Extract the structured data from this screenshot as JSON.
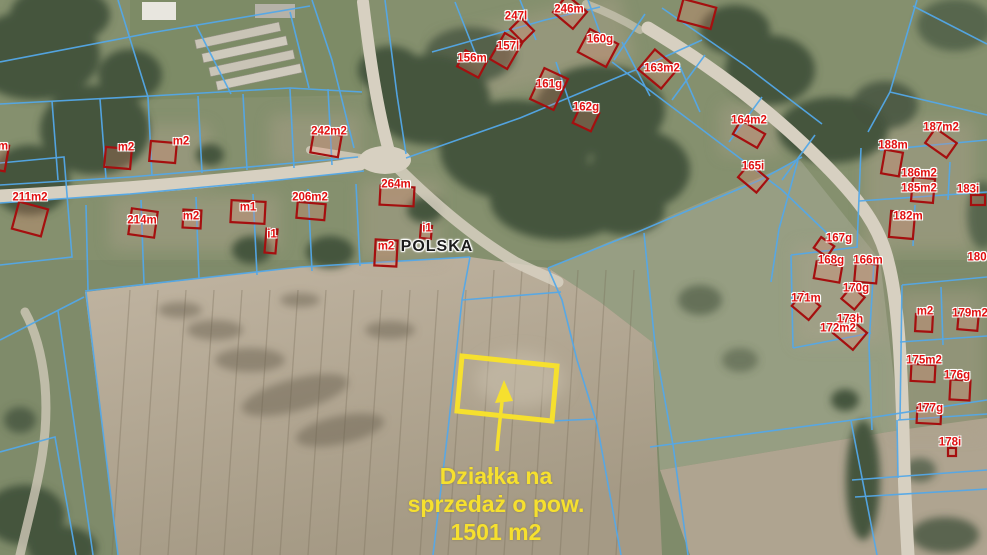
{
  "map": {
    "country_label": "POLSKA",
    "annotation": {
      "line1": "Działka na",
      "line2": "sprzedaż o pow.",
      "line3": "1501 m2",
      "area_value": "1501 m2"
    },
    "colors": {
      "parcel_boundary": "#54a8e8",
      "building_outline": "#a50f0f",
      "building_fill": "rgba(255,130,110,0.22)",
      "label_text": "#e01010",
      "highlight": "#f6e02e",
      "country_text": "#1c1c1c"
    },
    "parcel_labels": [
      {
        "text": "247l",
        "x": 516,
        "y": 17
      },
      {
        "text": "246m",
        "x": 569,
        "y": 10
      },
      {
        "text": "156m",
        "x": 472,
        "y": 59
      },
      {
        "text": "157l",
        "x": 508,
        "y": 47
      },
      {
        "text": "160g",
        "x": 600,
        "y": 40
      },
      {
        "text": "163m2",
        "x": 662,
        "y": 69
      },
      {
        "text": "161g",
        "x": 549,
        "y": 85
      },
      {
        "text": "162g",
        "x": 586,
        "y": 108
      },
      {
        "text": "164m2",
        "x": 749,
        "y": 121
      },
      {
        "text": "165i",
        "x": 753,
        "y": 167
      },
      {
        "text": "187m2",
        "x": 941,
        "y": 128
      },
      {
        "text": "188m",
        "x": 893,
        "y": 146
      },
      {
        "text": "186m2",
        "x": 919,
        "y": 174
      },
      {
        "text": "185m2",
        "x": 919,
        "y": 189
      },
      {
        "text": "183i",
        "x": 968,
        "y": 190
      },
      {
        "text": "182m",
        "x": 908,
        "y": 217
      },
      {
        "text": "167g",
        "x": 839,
        "y": 239
      },
      {
        "text": "168g",
        "x": 831,
        "y": 261
      },
      {
        "text": "166m",
        "x": 868,
        "y": 261
      },
      {
        "text": "170g",
        "x": 856,
        "y": 289
      },
      {
        "text": "171m",
        "x": 806,
        "y": 299
      },
      {
        "text": "173h",
        "x": 850,
        "y": 320
      },
      {
        "text": "172m2",
        "x": 838,
        "y": 329
      },
      {
        "text": "m2",
        "x": 925,
        "y": 312
      },
      {
        "text": "179m2",
        "x": 970,
        "y": 314
      },
      {
        "text": "180",
        "x": 977,
        "y": 258
      },
      {
        "text": "175m2",
        "x": 924,
        "y": 361
      },
      {
        "text": "176g",
        "x": 957,
        "y": 376
      },
      {
        "text": "177g",
        "x": 930,
        "y": 409
      },
      {
        "text": "178i",
        "x": 950,
        "y": 443
      },
      {
        "text": "211m2",
        "x": 30,
        "y": 198
      },
      {
        "text": "m2",
        "x": 126,
        "y": 148
      },
      {
        "text": "m2",
        "x": 181,
        "y": 142
      },
      {
        "text": "242m2",
        "x": 329,
        "y": 132
      },
      {
        "text": "214m",
        "x": 142,
        "y": 221
      },
      {
        "text": "m2",
        "x": 191,
        "y": 217
      },
      {
        "text": "m1",
        "x": 248,
        "y": 208
      },
      {
        "text": "i1",
        "x": 272,
        "y": 235
      },
      {
        "text": "206m2",
        "x": 310,
        "y": 198
      },
      {
        "text": "264m",
        "x": 396,
        "y": 185
      },
      {
        "text": "m2",
        "x": 386,
        "y": 247
      },
      {
        "text": "i1",
        "x": 427,
        "y": 229
      },
      {
        "text": "m",
        "x": 3,
        "y": 147
      }
    ],
    "buildings": [
      {
        "x": 522,
        "y": 30,
        "w": 18,
        "h": 16,
        "r": 45
      },
      {
        "x": 570,
        "y": 12,
        "w": 26,
        "h": 22,
        "r": 40
      },
      {
        "x": 472,
        "y": 64,
        "w": 24,
        "h": 18,
        "r": 28
      },
      {
        "x": 506,
        "y": 51,
        "w": 20,
        "h": 30,
        "r": 30
      },
      {
        "x": 598,
        "y": 48,
        "w": 32,
        "h": 26,
        "r": 28
      },
      {
        "x": 658,
        "y": 69,
        "w": 30,
        "h": 26,
        "r": 40
      },
      {
        "x": 549,
        "y": 89,
        "w": 26,
        "h": 34,
        "r": 25
      },
      {
        "x": 586,
        "y": 118,
        "w": 20,
        "h": 20,
        "r": 25
      },
      {
        "x": 697,
        "y": 14,
        "w": 34,
        "h": 22,
        "r": 15
      },
      {
        "x": 749,
        "y": 134,
        "w": 28,
        "h": 16,
        "r": 30
      },
      {
        "x": 753,
        "y": 178,
        "w": 24,
        "h": 18,
        "r": 40
      },
      {
        "x": 941,
        "y": 143,
        "w": 26,
        "h": 18,
        "r": 35
      },
      {
        "x": 892,
        "y": 163,
        "w": 18,
        "h": 24,
        "r": 10
      },
      {
        "x": 923,
        "y": 190,
        "w": 22,
        "h": 24,
        "r": 5
      },
      {
        "x": 978,
        "y": 200,
        "w": 14,
        "h": 10,
        "r": 0
      },
      {
        "x": 902,
        "y": 225,
        "w": 24,
        "h": 26,
        "r": 5
      },
      {
        "x": 824,
        "y": 247,
        "w": 16,
        "h": 13,
        "r": 35
      },
      {
        "x": 828,
        "y": 272,
        "w": 26,
        "h": 17,
        "r": 10
      },
      {
        "x": 866,
        "y": 273,
        "w": 22,
        "h": 19,
        "r": 5
      },
      {
        "x": 853,
        "y": 298,
        "w": 17,
        "h": 16,
        "r": 40
      },
      {
        "x": 806,
        "y": 306,
        "w": 22,
        "h": 18,
        "r": 40
      },
      {
        "x": 850,
        "y": 333,
        "w": 26,
        "h": 22,
        "r": 40
      },
      {
        "x": 924,
        "y": 323,
        "w": 17,
        "h": 17,
        "r": 3
      },
      {
        "x": 968,
        "y": 322,
        "w": 20,
        "h": 16,
        "r": 5
      },
      {
        "x": 923,
        "y": 373,
        "w": 24,
        "h": 17,
        "r": 3
      },
      {
        "x": 960,
        "y": 390,
        "w": 20,
        "h": 20,
        "r": 3
      },
      {
        "x": 929,
        "y": 415,
        "w": 24,
        "h": 17,
        "r": 3
      },
      {
        "x": 952,
        "y": 452,
        "w": 8,
        "h": 8,
        "r": 0
      },
      {
        "x": 30,
        "y": 219,
        "w": 30,
        "h": 28,
        "r": 15
      },
      {
        "x": -2,
        "y": 157,
        "w": 18,
        "h": 26,
        "r": 10
      },
      {
        "x": 118,
        "y": 158,
        "w": 26,
        "h": 20,
        "r": 5
      },
      {
        "x": 163,
        "y": 152,
        "w": 26,
        "h": 20,
        "r": 5
      },
      {
        "x": 326,
        "y": 144,
        "w": 28,
        "h": 22,
        "r": 10
      },
      {
        "x": 143,
        "y": 223,
        "w": 26,
        "h": 26,
        "r": 8
      },
      {
        "x": 192,
        "y": 219,
        "w": 18,
        "h": 18,
        "r": 3
      },
      {
        "x": 248,
        "y": 212,
        "w": 34,
        "h": 22,
        "r": 3
      },
      {
        "x": 271,
        "y": 241,
        "w": 11,
        "h": 24,
        "r": 5
      },
      {
        "x": 311,
        "y": 211,
        "w": 28,
        "h": 16,
        "r": 5
      },
      {
        "x": 397,
        "y": 196,
        "w": 34,
        "h": 19,
        "r": 3
      },
      {
        "x": 386,
        "y": 253,
        "w": 22,
        "h": 26,
        "r": 3
      },
      {
        "x": 426,
        "y": 232,
        "w": 11,
        "h": 13,
        "r": 5
      }
    ]
  }
}
